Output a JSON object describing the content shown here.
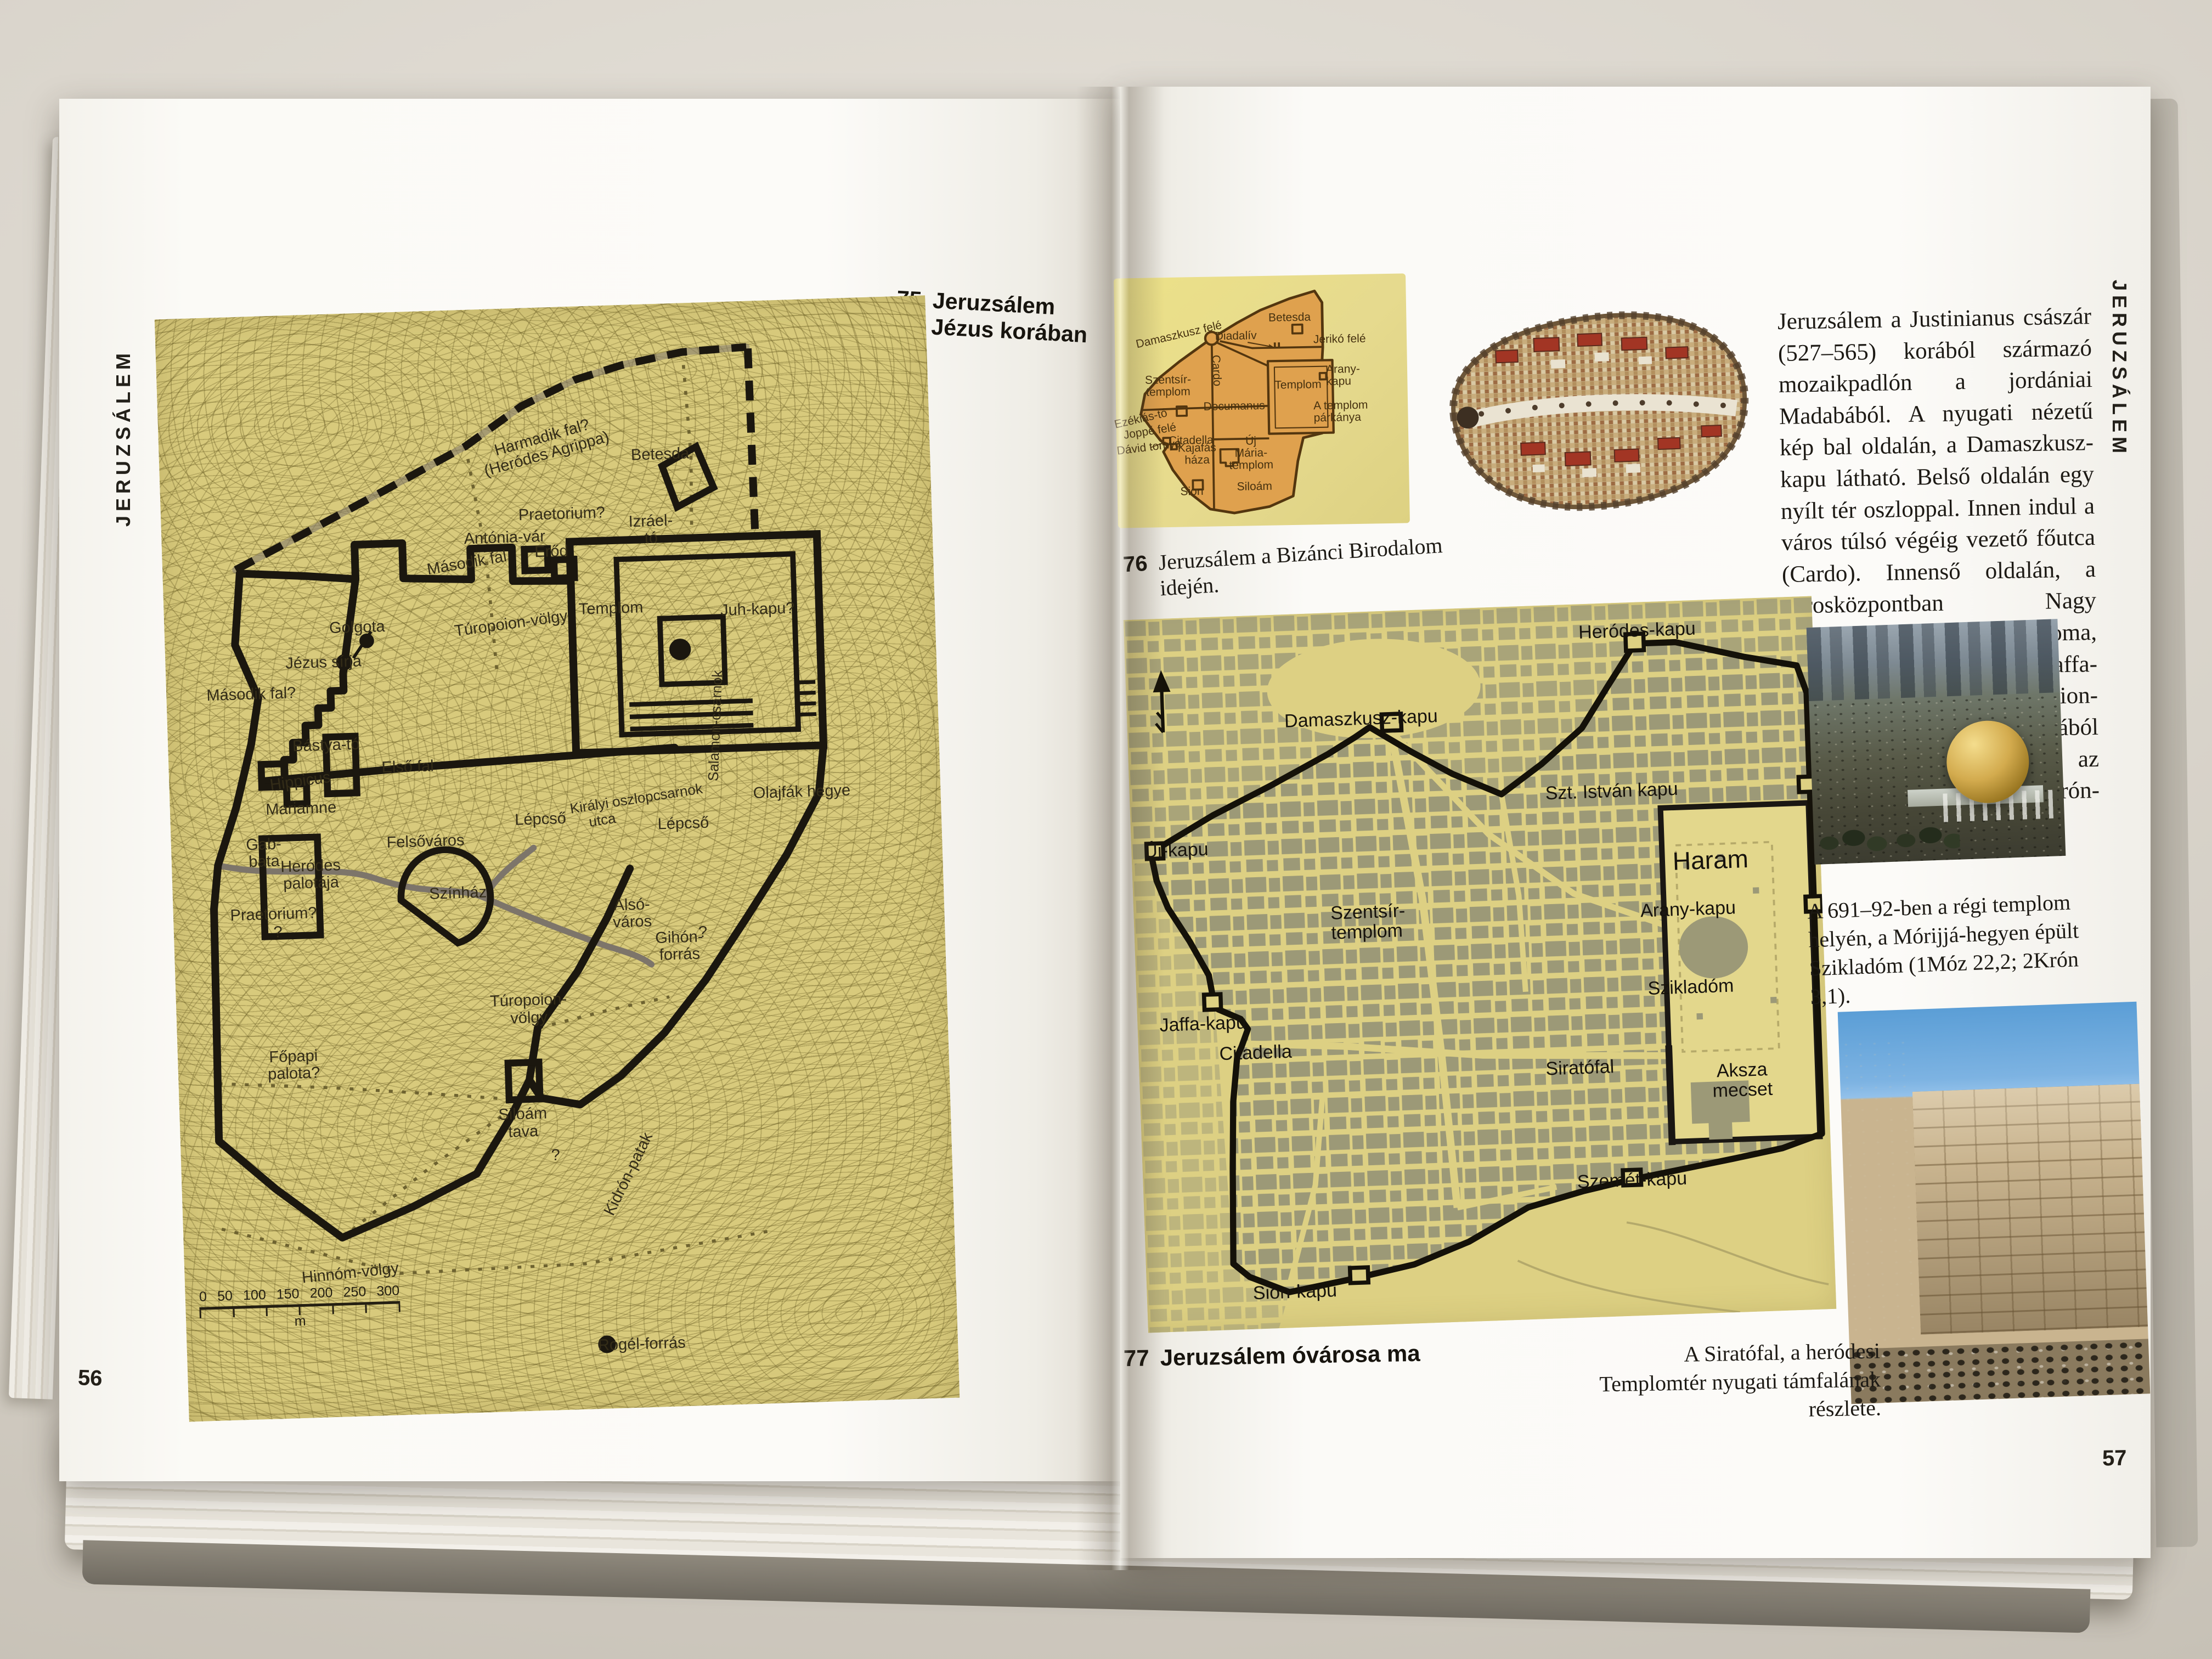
{
  "left_page": {
    "tab": "JERUZSÁLEM",
    "page_number": "56",
    "caption": {
      "number": "75",
      "text": "Jeruzsálem\nJézus korában"
    },
    "map": {
      "labels": [
        "Harmadik fal?\n(Heródes Agrippa)",
        "Betesda",
        "Praetorium?",
        "Antónia-vár",
        "Erőd",
        "Izráel-\ntó",
        "Második fal",
        "Juh-kapu?",
        "Templom",
        "Golgota",
        "Jézus sírja",
        "Második fal?",
        "Túropoion-völgy",
        "Bástya-tó",
        "Első fal",
        "Hippicus",
        "Mariamne",
        "Lépcső",
        "Felsőváros",
        "Gab-\nbata",
        "Heródes\npalotája",
        "Praetorium?",
        "Színház",
        "Királyi oszlopcsarnok",
        "utca",
        "Lépcső",
        "Olajfák hegye",
        "Salamon-csarnok",
        "Alsó-\nváros",
        "Gihón-\nforrás",
        "Túropoion-\nvölgy",
        "Főpapi\npalota?",
        "Siloám\ntava",
        "Kidrón-patak",
        "Hinnóm-völgy",
        "Rogél-forrás",
        "?",
        "?",
        "?"
      ],
      "scale_ticks": [
        "0",
        "50",
        "100",
        "150",
        "200",
        "250",
        "300"
      ],
      "scale_unit": "m"
    }
  },
  "right_page": {
    "tab": "JERUZSÁLEM",
    "page_number": "57",
    "fig76": {
      "number": "76",
      "caption": "Jeruzsálem a Bizánci Birodalom idején.",
      "labels": [
        "Damaszkusz felé",
        "Diadalív",
        "Betesda",
        "Jerikó felé",
        "Cardo",
        "Templom",
        "Arany-\nkapu",
        "Szentsír-\ntemplom",
        "Decumanus",
        "A templom\npárkánya",
        "Ezékiás-tó",
        "Joppé felé",
        "Dávid tornya",
        "Citadella",
        "Kajafás\nháza",
        "Új\nMária-\ntemplom",
        "Sion",
        "Siloám"
      ]
    },
    "article": "Jeruzsálem a Justinianus császár (527–565) korából származó mozaikpadlón a jordániai Madabából. A nyugati nézetű kép bal oldalán, a Damaszkusz-kapu látható. Belső oldalán egy nyílt tér oszloppal. Innen indul a város túlsó végéig vezető főutca (Cardo). Innenső oldalán, a városközpontban Nagy Konstantin Szentsír-temploma, tőle jobbra, az előtérben a Jaffa-kapu. A háttérben a Türopoion-völgyön végigfutó utcából ágazik ki kelet felé az Oroszlános-kapun át a Kidrón-völgy felé vezető út.",
    "fig77": {
      "number": "77",
      "caption": "Jeruzsálem óvárosa ma",
      "labels": [
        "Heródes-kapu",
        "Damaszkusz-kapu",
        "Új-kapu",
        "Szt. István kapu",
        "Haram",
        "Arany-kapu",
        "Szikladóm",
        "Szentsír-\ntemplom",
        "Siratófal",
        "Aksza\nmecset",
        "Jaffa-kapu",
        "Citadella",
        "Szemét-kapu",
        "Sion-kapu"
      ]
    },
    "photo1_caption": "A 691–92-ben a régi templom helyén, a Mórijjá-hegyen épült Szikladóm (1Móz 22,2; 2Krón 3,1).",
    "photo2_caption": "A Siratófal, a heródesi Templomtér nyugati támfalának részlete."
  }
}
